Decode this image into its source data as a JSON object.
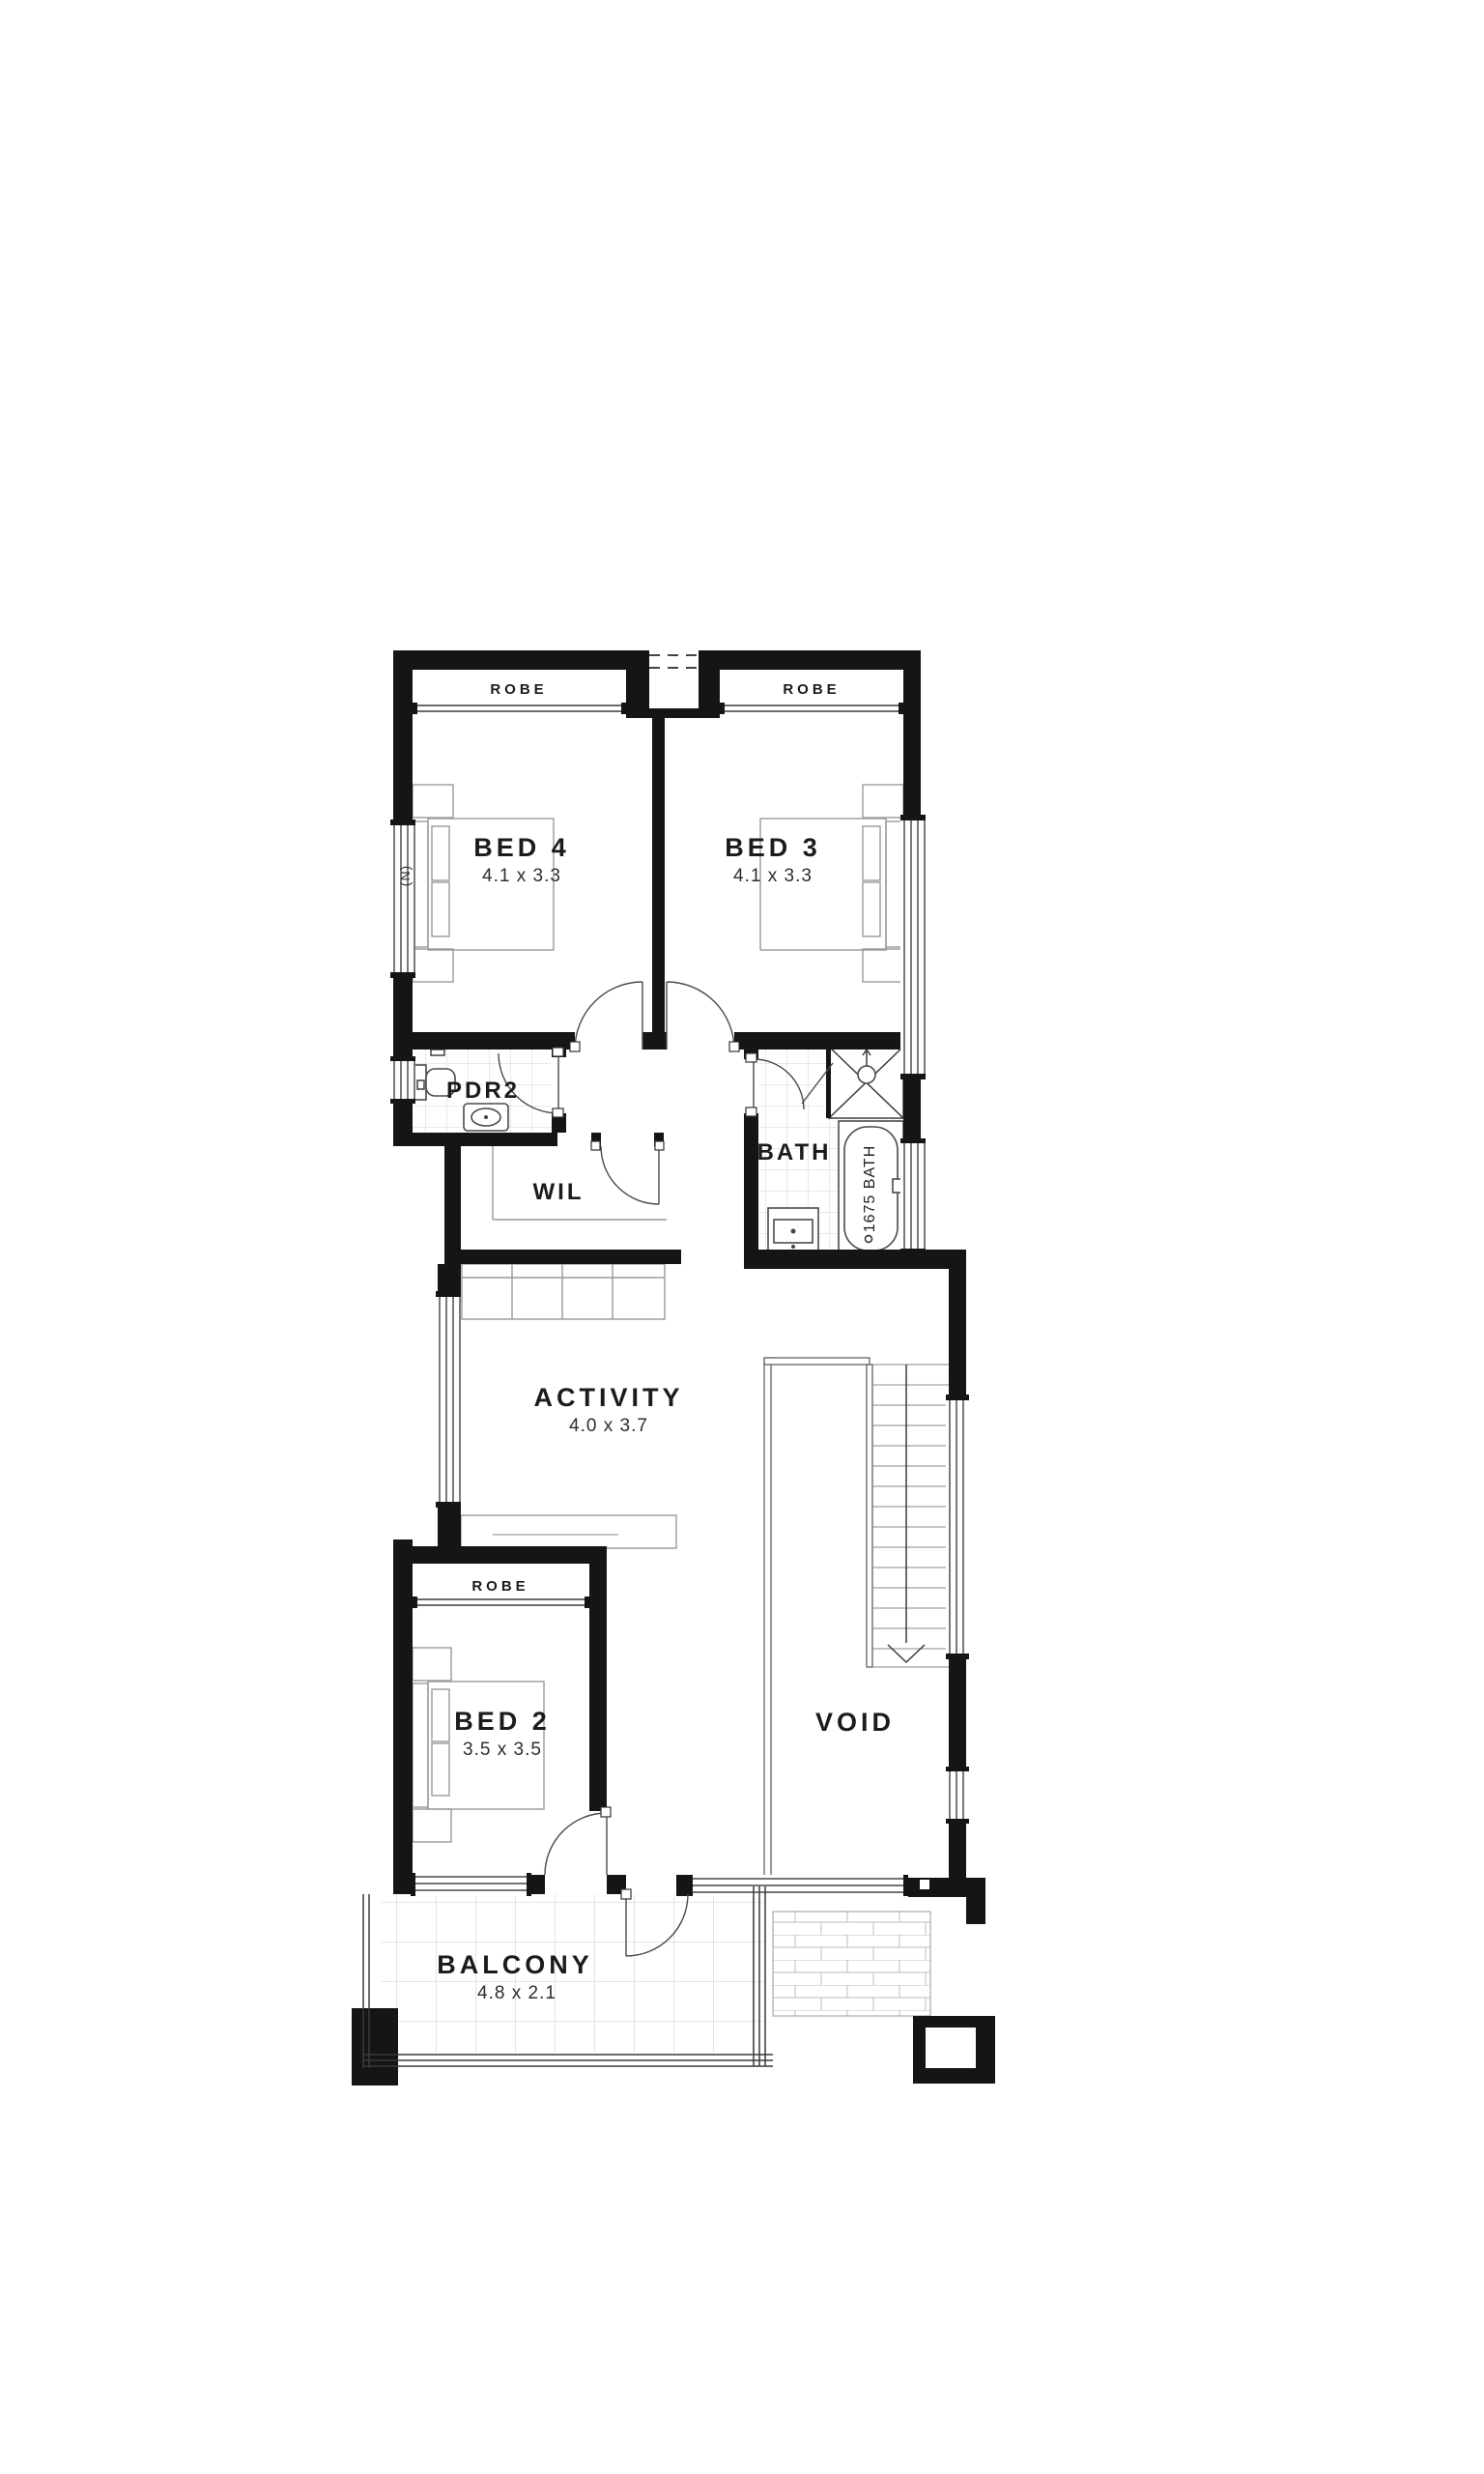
{
  "floorplan": {
    "rooms": {
      "bed4": {
        "label": "BED 4",
        "dims": "4.1 x 3.3"
      },
      "bed3": {
        "label": "BED 3",
        "dims": "4.1 x 3.3"
      },
      "pdr2": {
        "label": "PDR2"
      },
      "wil": {
        "label": "WIL"
      },
      "bath": {
        "label": "BATH"
      },
      "activity": {
        "label": "ACTIVITY",
        "dims": "4.0 x 3.7"
      },
      "bed2": {
        "label": "BED 2",
        "dims": "3.5 x 3.5"
      },
      "void": {
        "label": "VOID"
      },
      "balcony": {
        "label": "BALCONY",
        "dims": "4.8 x 2.1"
      }
    },
    "wardrobes": {
      "bed4_robe": "ROBE",
      "bed3_robe": "ROBE",
      "bed2_robe": "ROBE"
    },
    "fixtures": {
      "bathtub_label": "1675 BATH"
    },
    "annotations": {
      "window_note": "(N)"
    },
    "colors": {
      "wall": "#151515",
      "background": "#ffffff",
      "tile_grid": "#c9c9c9"
    }
  }
}
